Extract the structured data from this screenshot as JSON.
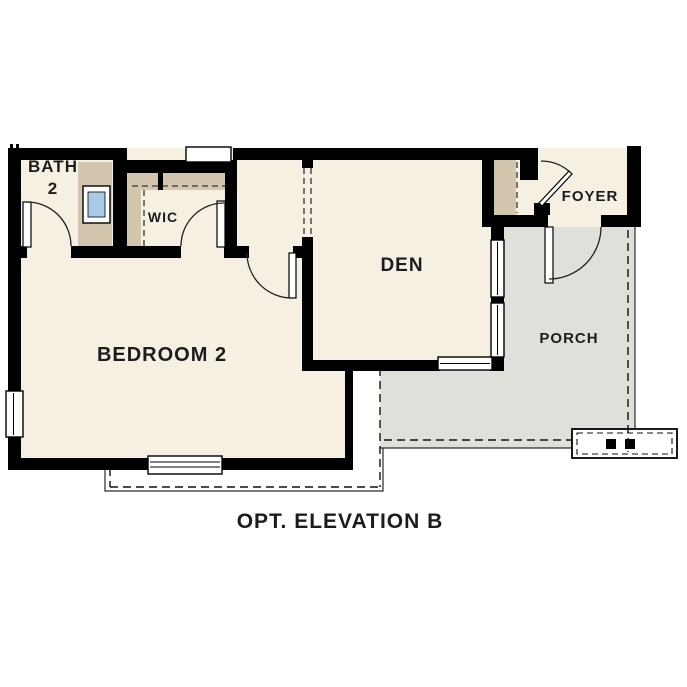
{
  "palette": {
    "background_white": "#ffffff",
    "floor_cream": "#f6f0e3",
    "cabinet_tan": "#d3c6ae",
    "porch_gray": "#e0e0db",
    "window_blue": "#a9cae8",
    "wall_black": "#000000",
    "text_dark": "#1c1c1c"
  },
  "rooms": {
    "bath": {
      "line1": "BATH",
      "line2": "2"
    },
    "wic": {
      "label": "WIC"
    },
    "bedroom": {
      "label": "BEDROOM 2"
    },
    "den": {
      "label": "DEN"
    },
    "foyer": {
      "label": "FOYER"
    },
    "porch": {
      "label": "PORCH"
    }
  },
  "caption": {
    "label": "OPT. ELEVATION B"
  },
  "symbols": {
    "utility_box": "electrical-meter-box",
    "dashed_outline": "roof-overhang-line",
    "wall_break": "plan-cut-marks"
  }
}
